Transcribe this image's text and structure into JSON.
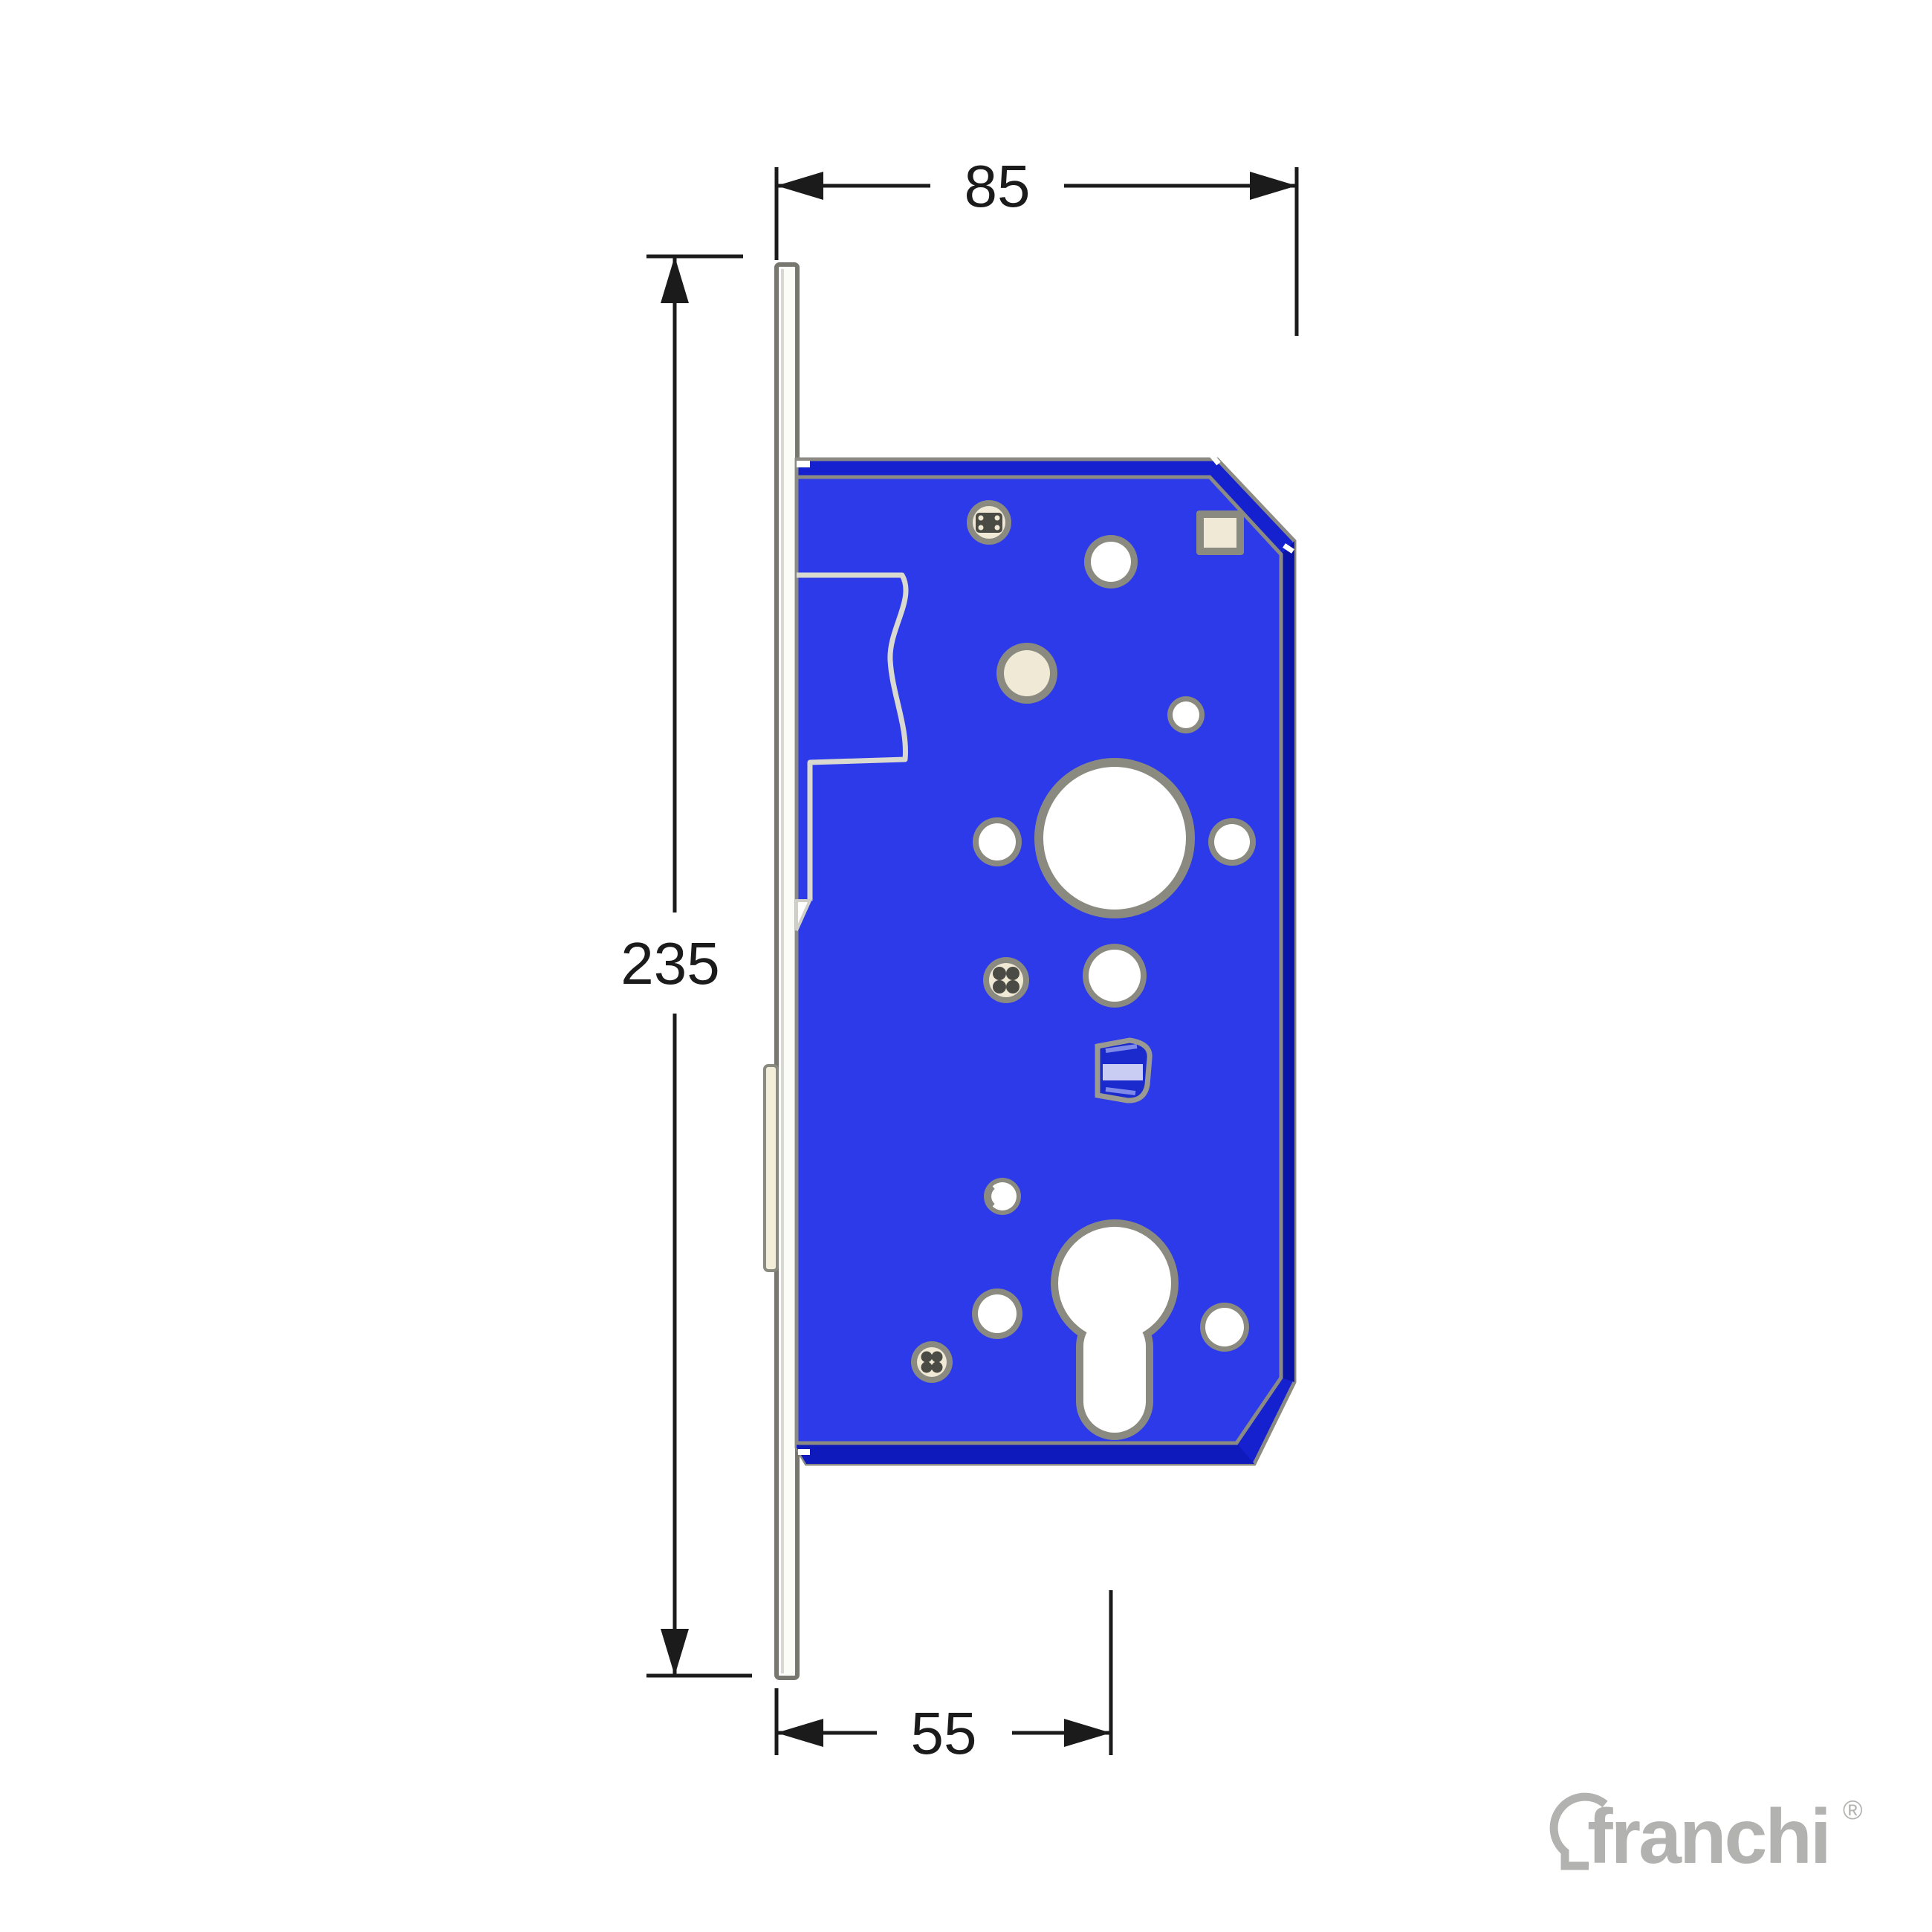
{
  "drawing": {
    "title": "mortise lock dimension diagram",
    "dimensions": {
      "overall_width_mm": "85",
      "overall_height_mm": "235",
      "backset_mm": "55"
    },
    "colors": {
      "body_blue": "#2c3ae9",
      "side_blue": "#1520cf",
      "deep_blue": "#0a14a8",
      "outline_gray": "#8b8b84",
      "ring_gray": "#8a8a80",
      "cream": "#efe9d5",
      "faceplate_white": "#fbfbf8",
      "dimension_black": "#1b1b1b",
      "logo_gray": "#b2b2b0",
      "clip_navy": "#1a2acd",
      "clip_lavender": "#c9cdf4"
    }
  },
  "branding": {
    "logo_text": "franchi",
    "registered_mark": "®"
  }
}
